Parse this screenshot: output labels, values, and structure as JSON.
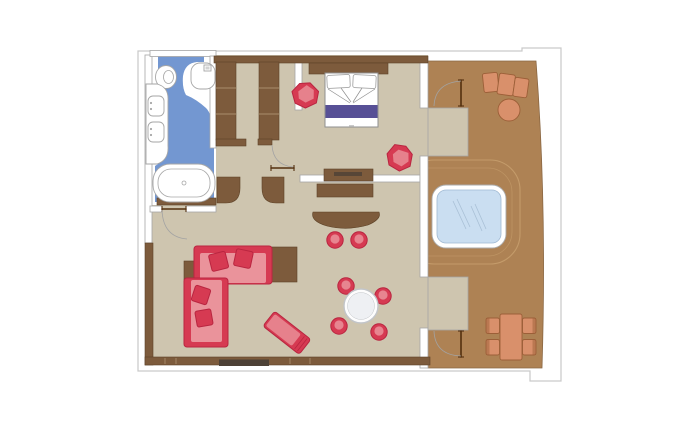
{
  "colors": {
    "outline": "#c9c9c9",
    "floor": "#cec5af",
    "terrace": "#ae8254",
    "terrace_edge": "#8a6743",
    "deck_line": "#c8a06e",
    "wall": "#7d5b3c",
    "wall_dark": "#5d4227",
    "wall_sep": "#a98c6b",
    "media": "#4d4136",
    "bath_blue": "#7397d1",
    "fixture_stroke": "#a6a6a6",
    "bed_stroke": "#8f8f8f",
    "purple": "#575096",
    "red": "#d63a52",
    "red_dark": "#b92540",
    "red_light": "#ea939b",
    "terracotta": "#d9906b",
    "terracotta_dark": "#9c5f38",
    "jacuzzi_water": "#cadef1",
    "jacuzzi_stroke": "#9fb8d2",
    "jacuzzi_line": "#a9c0d6",
    "arc": "#a3a3a3",
    "door": "#53300f",
    "table_top": "#eef0f3",
    "table_ring": "#c2c5c9"
  },
  "floorplan": {
    "type": "suite-floor-plan",
    "rooms": [
      {
        "name": "bathroom",
        "furniture": [
          "toilet",
          "bidet",
          "vanity-double-sink",
          "bathtub"
        ]
      },
      {
        "name": "dressing-corridor",
        "furniture": [
          "wardrobe-left",
          "wardrobe-right"
        ]
      },
      {
        "name": "bedroom",
        "furniture": [
          "double-bed",
          "headboard",
          "armchair",
          "armchair",
          "tv-console"
        ]
      },
      {
        "name": "living-room",
        "furniture": [
          "l-shaped-sofa",
          "sofa-pillows",
          "chaise-longue",
          "side-table",
          "console-table",
          "desk",
          "bar-counter",
          "bar-stool",
          "bar-stool",
          "round-dining-table",
          "stool",
          "stool",
          "stool",
          "stool",
          "media-unit"
        ]
      },
      {
        "name": "terrace",
        "furniture": [
          "sun-lounger",
          "round-side-table",
          "whirlpool-tub",
          "outdoor-dining-table",
          "outdoor-chair",
          "outdoor-chair",
          "outdoor-chair",
          "outdoor-chair"
        ]
      }
    ],
    "doors": [
      "entrance-door",
      "living-room-door",
      "bedroom-terrace-door",
      "living-terrace-door"
    ]
  }
}
